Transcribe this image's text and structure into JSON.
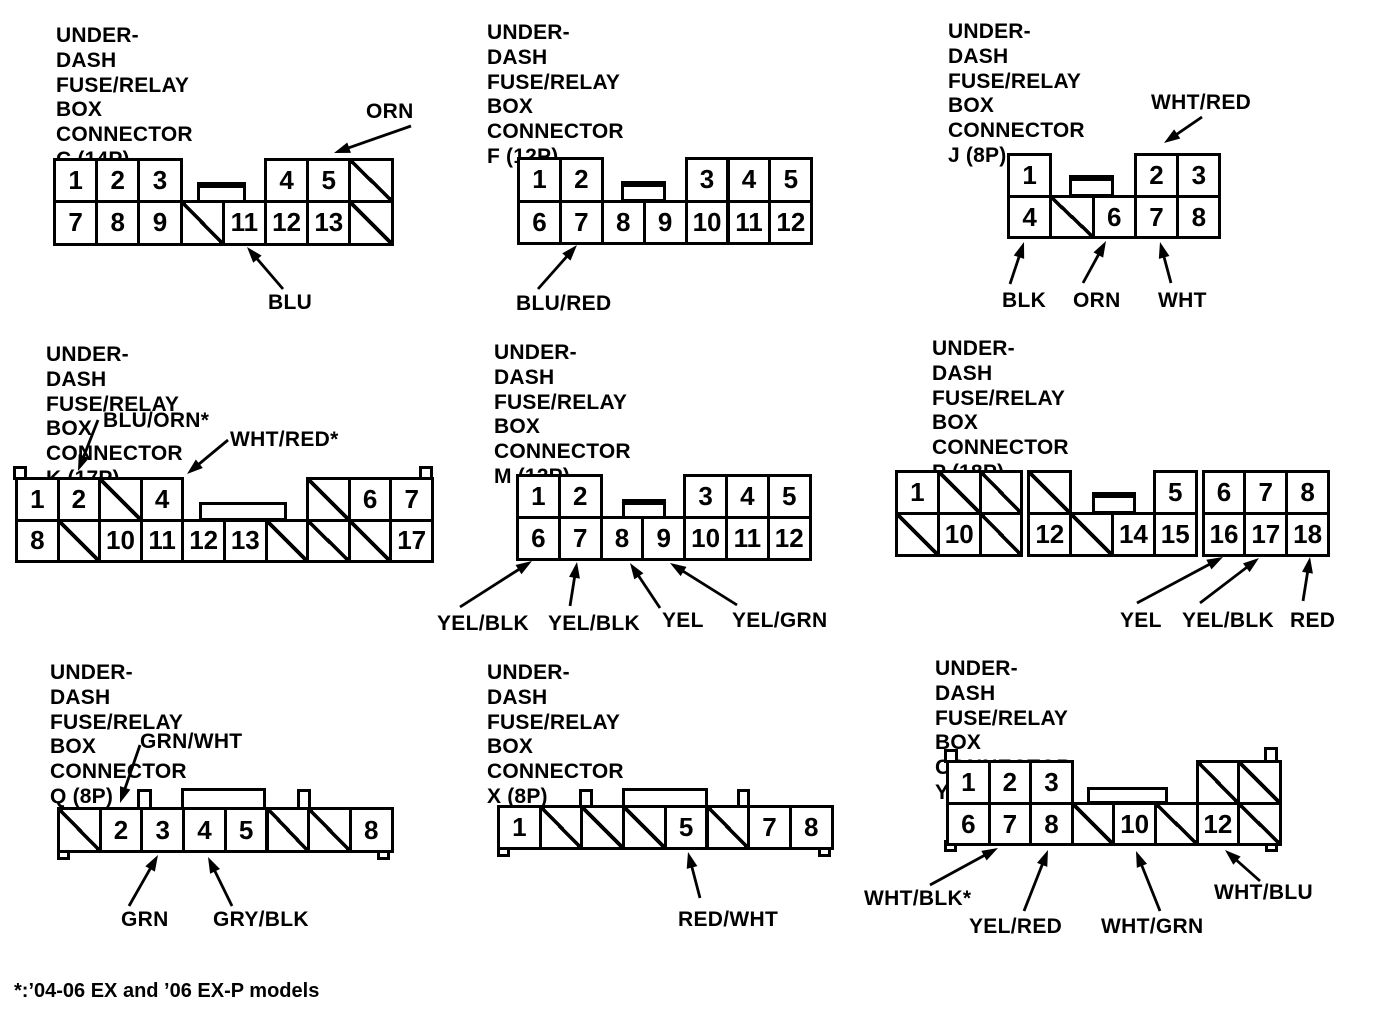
{
  "page": {
    "background": "#ffffff",
    "ink": "#000000"
  },
  "footer": {
    "note": "*:’04-06 EX and ’06 EX-P models"
  },
  "connectors": [
    {
      "id": "C",
      "title": {
        "x": 56,
        "y": 24,
        "lines": [
          "UNDER-DASH FUSE/RELAY BOX",
          "CONNECTOR C (14P)"
        ]
      },
      "grid": {
        "x": 53,
        "y": 158,
        "cw": 42.2,
        "ch": 42.3,
        "rows": [
          [
            "1",
            "2",
            "3",
            ".",
            ".",
            "4",
            "5",
            "/"
          ],
          [
            "7",
            "8",
            "9",
            "/",
            "11",
            "12",
            "13",
            "/"
          ]
        ]
      },
      "shapes": [
        {
          "cls": "latch",
          "x": 197,
          "y": 182,
          "w": 49,
          "h": 21,
          "mid": true
        }
      ],
      "labels": [
        {
          "text": "ORN",
          "x": 366,
          "y": 100
        },
        {
          "text": "BLU",
          "x": 268,
          "y": 291
        }
      ],
      "arrows": [
        {
          "x1": 411,
          "y1": 126,
          "x2": 334,
          "y2": 153
        },
        {
          "x1": 283,
          "y1": 289,
          "x2": 247,
          "y2": 247
        }
      ]
    },
    {
      "id": "F",
      "title": {
        "x": 487,
        "y": 21,
        "lines": [
          "UNDER-DASH FUSE/RELAY BOX",
          "CONNECTOR F (12P)"
        ]
      },
      "grid": {
        "x": 517,
        "y": 157,
        "cw": 41.9,
        "ch": 42.5,
        "rows": [
          [
            "1",
            "2",
            ".",
            ".",
            "3",
            "4",
            "5"
          ],
          [
            "6",
            "7",
            "8",
            "9",
            "10",
            "11",
            "12"
          ]
        ]
      },
      "shapes": [
        {
          "cls": "latch",
          "x": 621,
          "y": 181,
          "w": 45,
          "h": 21,
          "mid": true
        }
      ],
      "labels": [
        {
          "text": "BLU/RED",
          "x": 516,
          "y": 292
        }
      ],
      "arrows": [
        {
          "x1": 538,
          "y1": 289,
          "x2": 577,
          "y2": 245
        }
      ]
    },
    {
      "id": "J",
      "title": {
        "x": 948,
        "y": 20,
        "lines": [
          "UNDER-DASH FUSE/RELAY BOX",
          "CONNECTOR J (8P)"
        ]
      },
      "grid": {
        "x": 1007,
        "y": 153,
        "cw": 42.3,
        "ch": 41.7,
        "rows": [
          [
            "1",
            ".",
            ".",
            "2",
            "3"
          ],
          [
            "4",
            "/",
            "6",
            "7",
            "8"
          ]
        ]
      },
      "shapes": [
        {
          "cls": "latch",
          "x": 1069,
          "y": 175,
          "w": 45,
          "h": 22,
          "mid": true
        }
      ],
      "labels": [
        {
          "text": "WHT/RED",
          "x": 1151,
          "y": 91
        },
        {
          "text": "BLK",
          "x": 1002,
          "y": 289
        },
        {
          "text": "ORN",
          "x": 1073,
          "y": 289
        },
        {
          "text": "WHT",
          "x": 1158,
          "y": 289
        }
      ],
      "arrows": [
        {
          "x1": 1202,
          "y1": 117,
          "x2": 1164,
          "y2": 143
        },
        {
          "x1": 1010,
          "y1": 284,
          "x2": 1024,
          "y2": 242
        },
        {
          "x1": 1083,
          "y1": 283,
          "x2": 1106,
          "y2": 241
        },
        {
          "x1": 1171,
          "y1": 283,
          "x2": 1160,
          "y2": 242
        }
      ]
    },
    {
      "id": "K",
      "title": {
        "x": 46,
        "y": 343,
        "lines": [
          "UNDER-DASH FUSE/RELAY BOX",
          "CONNECTOR K (17P)"
        ]
      },
      "grid": {
        "x": 15,
        "y": 477,
        "cw": 41.6,
        "ch": 41.6,
        "rows": [
          [
            "1",
            "2",
            "/",
            "4",
            ".",
            ".",
            ".",
            "/",
            "6",
            "7"
          ],
          [
            "8",
            "/",
            "10",
            "11",
            "12",
            "13",
            "/",
            "/",
            "/",
            "17"
          ]
        ]
      },
      "shapes": [
        {
          "cls": "latch",
          "x": 199,
          "y": 502,
          "w": 88,
          "h": 19,
          "mid": false
        },
        {
          "cls": "ear",
          "x": 13,
          "y": 466,
          "w": 14,
          "h": 14
        },
        {
          "cls": "ear",
          "x": 419,
          "y": 466,
          "w": 14,
          "h": 14
        }
      ],
      "labels": [
        {
          "text": "BLU/ORN*",
          "x": 103,
          "y": 409
        },
        {
          "text": "WHT/RED*",
          "x": 230,
          "y": 428
        }
      ],
      "arrows": [
        {
          "x1": 98,
          "y1": 420,
          "x2": 78,
          "y2": 471
        },
        {
          "x1": 228,
          "y1": 440,
          "x2": 187,
          "y2": 474
        }
      ]
    },
    {
      "id": "M",
      "title": {
        "x": 494,
        "y": 341,
        "lines": [
          "UNDER-DASH FUSE/RELAY BOX",
          "CONNECTOR M (12P)"
        ]
      },
      "grid": {
        "x": 516,
        "y": 474,
        "cw": 41.8,
        "ch": 42.2,
        "rows": [
          [
            "1",
            "2",
            ".",
            ".",
            "3",
            "4",
            "5"
          ],
          [
            "6",
            "7",
            "8",
            "9",
            "10",
            "11",
            "12"
          ]
        ]
      },
      "shapes": [
        {
          "cls": "latch",
          "x": 622,
          "y": 499,
          "w": 44,
          "h": 20,
          "mid": true
        }
      ],
      "labels": [
        {
          "text": "YEL/BLK",
          "x": 437,
          "y": 612
        },
        {
          "text": "YEL/BLK",
          "x": 548,
          "y": 612
        },
        {
          "text": "YEL",
          "x": 662,
          "y": 609
        },
        {
          "text": "YEL/GRN",
          "x": 732,
          "y": 609
        }
      ],
      "arrows": [
        {
          "x1": 460,
          "y1": 607,
          "x2": 532,
          "y2": 561
        },
        {
          "x1": 570,
          "y1": 606,
          "x2": 577,
          "y2": 562
        },
        {
          "x1": 660,
          "y1": 608,
          "x2": 630,
          "y2": 563
        },
        {
          "x1": 737,
          "y1": 605,
          "x2": 670,
          "y2": 563
        }
      ]
    },
    {
      "id": "P",
      "title": {
        "x": 932,
        "y": 337,
        "lines": [
          "UNDER-DASH FUSE/RELAY BOX",
          "CONNECTOR P (18P)"
        ]
      },
      "grid": {
        "x": 895,
        "y": 470,
        "cw": 41.8,
        "ch": 41.8,
        "rows": [
          [
            "1",
            "/",
            "/",
            "|",
            "/",
            ".",
            ".",
            "5",
            "|",
            "6",
            "7",
            "8"
          ],
          [
            "/",
            "10",
            "/",
            "|",
            "12",
            "/",
            "14",
            "15",
            "|",
            "16",
            "17",
            "18"
          ]
        ]
      },
      "shapes": [
        {
          "cls": "latch",
          "x": 1092,
          "y": 492,
          "w": 44,
          "h": 22,
          "mid": true
        }
      ],
      "labels": [
        {
          "text": "YEL",
          "x": 1120,
          "y": 609
        },
        {
          "text": "YEL/BLK",
          "x": 1182,
          "y": 609
        },
        {
          "text": "RED",
          "x": 1290,
          "y": 609
        }
      ],
      "arrows": [
        {
          "x1": 1137,
          "y1": 603,
          "x2": 1223,
          "y2": 557
        },
        {
          "x1": 1200,
          "y1": 603,
          "x2": 1259,
          "y2": 558
        },
        {
          "x1": 1303,
          "y1": 601,
          "x2": 1310,
          "y2": 557
        }
      ]
    },
    {
      "id": "Q",
      "title": {
        "x": 50,
        "y": 661,
        "lines": [
          "UNDER-DASH FUSE/RELAY BOX",
          "CONNECTOR Q (8P)"
        ]
      },
      "grid": {
        "x": 57,
        "y": 807,
        "cw": 41.7,
        "ch": 43,
        "rows": [
          [
            "/",
            "2",
            "3",
            "4",
            "5",
            "/",
            "/",
            "8"
          ]
        ]
      },
      "shapes": [
        {
          "cls": "tab",
          "x": 137,
          "y": 789,
          "w": 15,
          "h": 21
        },
        {
          "cls": "latch",
          "x": 181,
          "y": 788,
          "w": 85,
          "h": 22,
          "mid": false
        },
        {
          "cls": "tab",
          "x": 297,
          "y": 789,
          "w": 14,
          "h": 21
        },
        {
          "cls": "foot",
          "x": 57,
          "y": 847,
          "w": 13,
          "h": 13
        },
        {
          "cls": "foot",
          "x": 377,
          "y": 847,
          "w": 13,
          "h": 13
        }
      ],
      "labels": [
        {
          "text": "GRN/WHT",
          "x": 140,
          "y": 730
        },
        {
          "text": "GRN",
          "x": 121,
          "y": 908
        },
        {
          "text": "GRY/BLK",
          "x": 213,
          "y": 908
        }
      ],
      "arrows": [
        {
          "x1": 140,
          "y1": 745,
          "x2": 120,
          "y2": 803
        },
        {
          "x1": 129,
          "y1": 906,
          "x2": 158,
          "y2": 855
        },
        {
          "x1": 232,
          "y1": 906,
          "x2": 208,
          "y2": 857
        }
      ]
    },
    {
      "id": "X",
      "title": {
        "x": 487,
        "y": 661,
        "lines": [
          "UNDER-DASH FUSE/RELAY BOX",
          "CONNECTOR X (8P)"
        ]
      },
      "grid": {
        "x": 497,
        "y": 805,
        "cw": 41.7,
        "ch": 42,
        "rows": [
          [
            "1",
            "/",
            "/",
            "/",
            "5",
            "/",
            "7",
            "8"
          ]
        ]
      },
      "shapes": [
        {
          "cls": "tab",
          "x": 579,
          "y": 789,
          "w": 14,
          "h": 19
        },
        {
          "cls": "latch",
          "x": 622,
          "y": 788,
          "w": 86,
          "h": 20,
          "mid": false
        },
        {
          "cls": "tab",
          "x": 737,
          "y": 789,
          "w": 13,
          "h": 19
        },
        {
          "cls": "foot",
          "x": 497,
          "y": 844,
          "w": 13,
          "h": 13
        },
        {
          "cls": "foot",
          "x": 818,
          "y": 844,
          "w": 13,
          "h": 13
        }
      ],
      "labels": [
        {
          "text": "RED/WHT",
          "x": 678,
          "y": 908
        }
      ],
      "arrows": [
        {
          "x1": 700,
          "y1": 898,
          "x2": 688,
          "y2": 852
        }
      ]
    },
    {
      "id": "Y",
      "title": {
        "x": 935,
        "y": 657,
        "lines": [
          "UNDER-DASH FUSE/RELAY BOX",
          "CONNECTOR Y (13P)"
        ]
      },
      "grid": {
        "x": 946,
        "y": 760,
        "cw": 41.6,
        "ch": 41.7,
        "rows": [
          [
            "1",
            "2",
            "3",
            ".",
            ".",
            ".",
            "/",
            "/"
          ],
          [
            "6",
            "7",
            "8",
            "/",
            "10",
            "/",
            "12",
            "/"
          ]
        ]
      },
      "shapes": [
        {
          "cls": "latch",
          "x": 1087,
          "y": 787,
          "w": 81,
          "h": 17,
          "mid": false
        },
        {
          "cls": "ear",
          "x": 944,
          "y": 749,
          "w": 14,
          "h": 14
        },
        {
          "cls": "ear",
          "x": 1264,
          "y": 747,
          "w": 14,
          "h": 16
        },
        {
          "cls": "foot",
          "x": 944,
          "y": 840,
          "w": 13,
          "h": 12
        },
        {
          "cls": "foot",
          "x": 1265,
          "y": 840,
          "w": 13,
          "h": 12
        }
      ],
      "labels": [
        {
          "text": "WHT/BLK*",
          "x": 864,
          "y": 887
        },
        {
          "text": "YEL/RED",
          "x": 969,
          "y": 915
        },
        {
          "text": "WHT/GRN",
          "x": 1101,
          "y": 915
        },
        {
          "text": "WHT/BLU",
          "x": 1214,
          "y": 881
        }
      ],
      "arrows": [
        {
          "x1": 930,
          "y1": 885,
          "x2": 998,
          "y2": 848
        },
        {
          "x1": 1024,
          "y1": 911,
          "x2": 1048,
          "y2": 850
        },
        {
          "x1": 1160,
          "y1": 911,
          "x2": 1136,
          "y2": 851
        },
        {
          "x1": 1260,
          "y1": 881,
          "x2": 1225,
          "y2": 850
        }
      ]
    }
  ]
}
